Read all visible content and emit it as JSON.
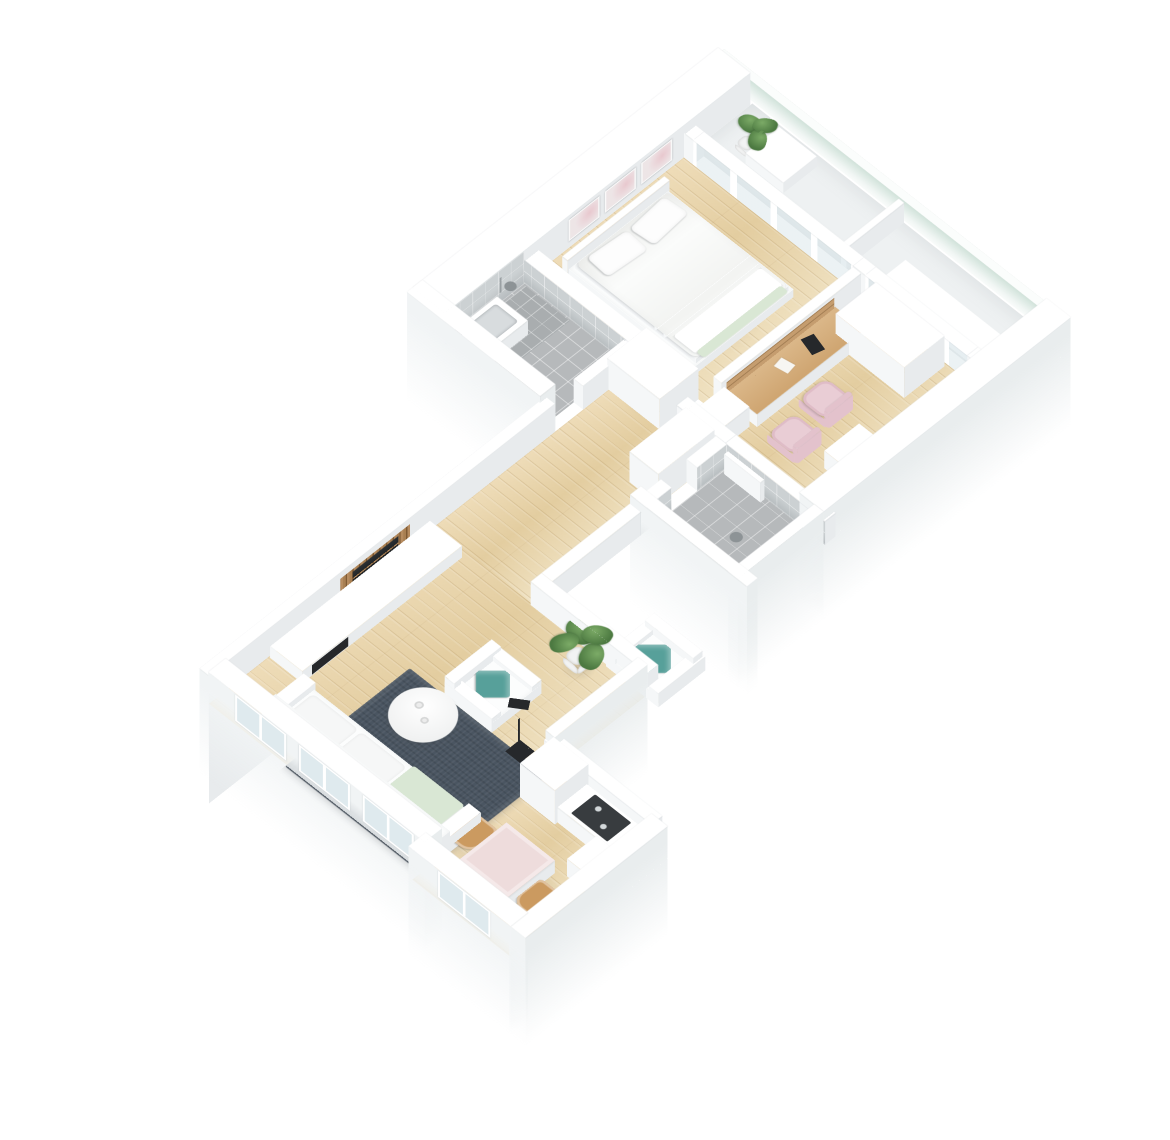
{
  "meta": {
    "title": "3D isometric floor plan render of a one-bedroom apartment",
    "style": "white walls, light pine wood floors, gray tiled bathrooms, white background"
  },
  "palette": {
    "background": "#ffffff",
    "wall_top": "#ffffff",
    "wall_side_light": "#f5f7f8",
    "wall_side_shade": "#e8ebed",
    "wood_floor": "#e9d6ae",
    "balcony_floor": "#eef1f2",
    "tile_floor": "#b6b9bb",
    "tile_wall": "#ccd1d3",
    "rug": "#4a5561",
    "accent_teal": "#57a09a",
    "accent_pink": "#e9cdd5",
    "accent_mint": "#d9e7d4",
    "wood_slats": "#a87f52",
    "railing_glass": "#cde0d7",
    "appliance_dark": "#383c3f"
  },
  "rooms": [
    {
      "name": "bedroom",
      "floor": "light wood",
      "contents": [
        "double bed with white duvet",
        "three wall art frames",
        "sliding glass door to balcony"
      ]
    },
    {
      "name": "balcony",
      "floor": "white concrete",
      "contents": [
        "glass railing",
        "potted plant",
        "white bench",
        "divider",
        "ledge unit"
      ]
    },
    {
      "name": "home office",
      "floor": "light wood",
      "contents": [
        "built-in wood desk with shelf wall",
        "two pink chairs",
        "white wardrobe",
        "dresser",
        "cabinet"
      ]
    },
    {
      "name": "bathroom",
      "floor": "gray tile",
      "contents": [
        "shower",
        "washbasin",
        "tiled walls"
      ]
    },
    {
      "name": "shower room",
      "floor": "gray tile",
      "contents": [
        "walk-in shower",
        "white door panel",
        "floor drain"
      ]
    },
    {
      "name": "hallway",
      "floor": "light wood",
      "contents": [
        "built-in wardrobe",
        "closet"
      ]
    },
    {
      "name": "living room",
      "floor": "light wood",
      "contents": [
        "white sofa with mint throw",
        "two white armchairs with teal pillows",
        "round white coffee table with two cups",
        "dark slate area rug",
        "black floor lamp",
        "TV sideboard with dark fireplace inset",
        "wood slat TV panel",
        "wall TV",
        "potted plant",
        "three facade windows"
      ]
    },
    {
      "name": "kitchen and dining",
      "floor": "light wood",
      "contents": [
        "tall cabinet",
        "white counter",
        "dark cooktop",
        "dining table with rose cloth",
        "two wooden chairs",
        "facade window"
      ]
    }
  ]
}
